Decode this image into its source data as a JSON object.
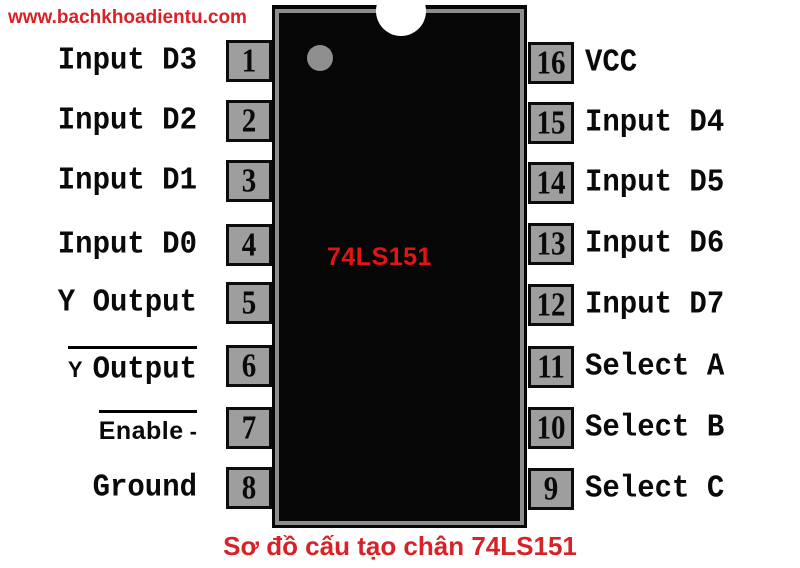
{
  "watermark": {
    "text": "www.bachkhoadientu.com"
  },
  "chip": {
    "label": "74LS151"
  },
  "caption": {
    "text": "Sơ đồ cấu tạo chân 74LS151"
  },
  "colors": {
    "accent_red": "#d92128",
    "chip_label_red": "#e31414",
    "pin_gray": "#9e9e9e",
    "chip_body_black": "#060606",
    "chip_border_gray": "#8d8d8d"
  },
  "pins": {
    "left": [
      {
        "num": "1",
        "label": "Input D3"
      },
      {
        "num": "2",
        "label": "Input D2"
      },
      {
        "num": "3",
        "label": "Input D1"
      },
      {
        "num": "4",
        "label": "Input D0"
      },
      {
        "num": "5",
        "label": "Y Output"
      },
      {
        "num": "6",
        "label": "Output",
        "prefix": "Y",
        "overline": true
      },
      {
        "num": "7",
        "label": "Enable",
        "suffix": "-",
        "overline": true,
        "sans": true
      },
      {
        "num": "8",
        "label": "Ground"
      }
    ],
    "right": [
      {
        "num": "16",
        "label": "VCC"
      },
      {
        "num": "15",
        "label": "Input D4"
      },
      {
        "num": "14",
        "label": "Input D5"
      },
      {
        "num": "13",
        "label": "Input D6"
      },
      {
        "num": "12",
        "label": "Input D7"
      },
      {
        "num": "11",
        "label": "Select A"
      },
      {
        "num": "10",
        "label": "Select B"
      },
      {
        "num": "9",
        "label": "Select C"
      }
    ]
  }
}
